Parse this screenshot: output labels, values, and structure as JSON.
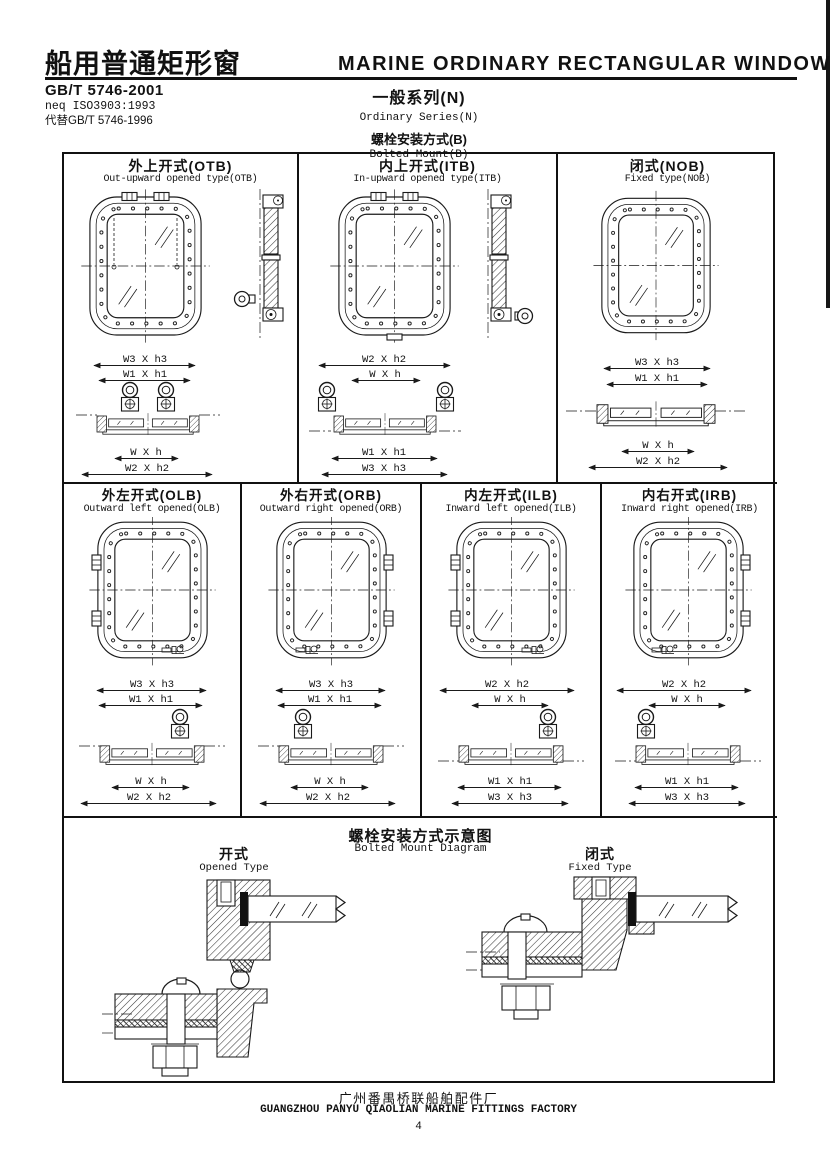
{
  "header": {
    "title_zh": "船用普通矩形窗",
    "title_en": "MARINE ORDINARY RECTANGULAR WINDOW",
    "std_code": "GB/T 5746-2001",
    "std_neq": "neq ISO3903:1993",
    "std_replace": "代替GB/T 5746-1996",
    "series_zh": "一般系列(N)",
    "series_en": "Ordinary Series(N)",
    "mount_zh": "螺栓安装方式(B)",
    "mount_en": "Bolted Mount(B)"
  },
  "cells": [
    {
      "id": "OTB",
      "title_zh": "外上开式(OTB)",
      "title_en": "Out-upward opened type(OTB)",
      "dims": [
        "W3 X h3",
        "W1 X h1",
        "W X h",
        "W2 X h2"
      ]
    },
    {
      "id": "ITB",
      "title_zh": "内上开式(ITB)",
      "title_en": "In-upward opened type(ITB)",
      "dims": [
        "W2 X h2",
        "W X h",
        "W1 X h1",
        "W3 X h3"
      ]
    },
    {
      "id": "NOB",
      "title_zh": "闭式(NOB)",
      "title_en": "Fixed type(NOB)",
      "dims": [
        "W3 X h3",
        "W1 X h1",
        "W X h",
        "W2 X h2"
      ]
    },
    {
      "id": "OLB",
      "title_zh": "外左开式(OLB)",
      "title_en": "Outward left opened(OLB)",
      "dims": [
        "W3 X h3",
        "W1 X h1",
        "W X h",
        "W2 X h2"
      ]
    },
    {
      "id": "ORB",
      "title_zh": "外右开式(ORB)",
      "title_en": "Outward right opened(ORB)",
      "dims": [
        "W3 X h3",
        "W1 X h1",
        "W X h",
        "W2 X h2"
      ]
    },
    {
      "id": "ILB",
      "title_zh": "内左开式(ILB)",
      "title_en": "Inward left opened(ILB)",
      "dims": [
        "W2 X h2",
        "W X h",
        "W1 X h1",
        "W3 X h3"
      ]
    },
    {
      "id": "IRB",
      "title_zh": "内右开式(IRB)",
      "title_en": "Inward right opened(IRB)",
      "dims": [
        "W2 X h2",
        "W X h",
        "W1 X h1",
        "W3 X h3"
      ]
    }
  ],
  "mount_diagram": {
    "title_zh": "螺栓安装方式示意图",
    "title_en": "Bolted Mount Diagram",
    "opened_zh": "开式",
    "opened_en": "Opened Type",
    "fixed_zh": "闭式",
    "fixed_en": "Fixed Type"
  },
  "footer": {
    "factory_zh": "广州番禺桥联船舶配件厂",
    "factory_en": "GUANGZHOU PANYU QIAOLIAN MARINE FITTINGS FACTORY",
    "page": "4"
  }
}
